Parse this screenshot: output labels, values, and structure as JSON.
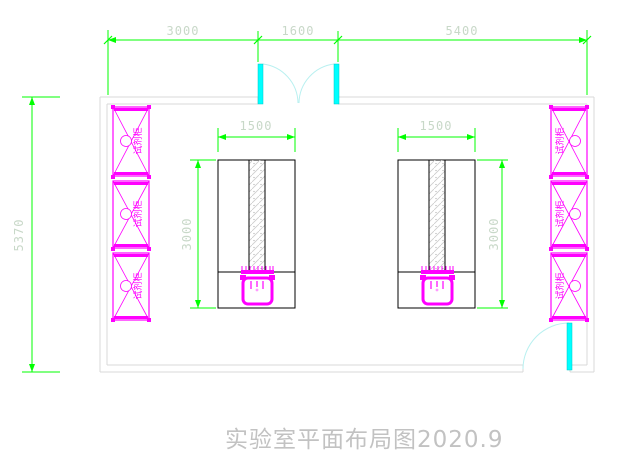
{
  "drawing": {
    "title": "实验室平面布局图2020.9"
  },
  "dimensions": {
    "top": [
      {
        "label": "3000"
      },
      {
        "label": "1600"
      },
      {
        "label": "5400"
      }
    ],
    "left": {
      "label": "5370"
    },
    "bench_width_left": "1500",
    "bench_width_right": "1500",
    "bench_depth_left": "3000",
    "bench_depth_right": "3000"
  },
  "cabinets": {
    "left": [
      "试剂柜",
      "试剂柜",
      "试剂柜"
    ],
    "right": [
      "试剂柜",
      "试剂柜",
      "试剂柜"
    ]
  },
  "colors": {
    "dimension_line": "#00ff00",
    "dimension_text": "#c8d8c8",
    "cabinet": "#ff00ff",
    "door_leaf": "#00ffff",
    "door_swing": "#b8f0f0",
    "wall": "#d8d8d8",
    "bench": "#000000",
    "title_text": "#c2c2c2"
  }
}
